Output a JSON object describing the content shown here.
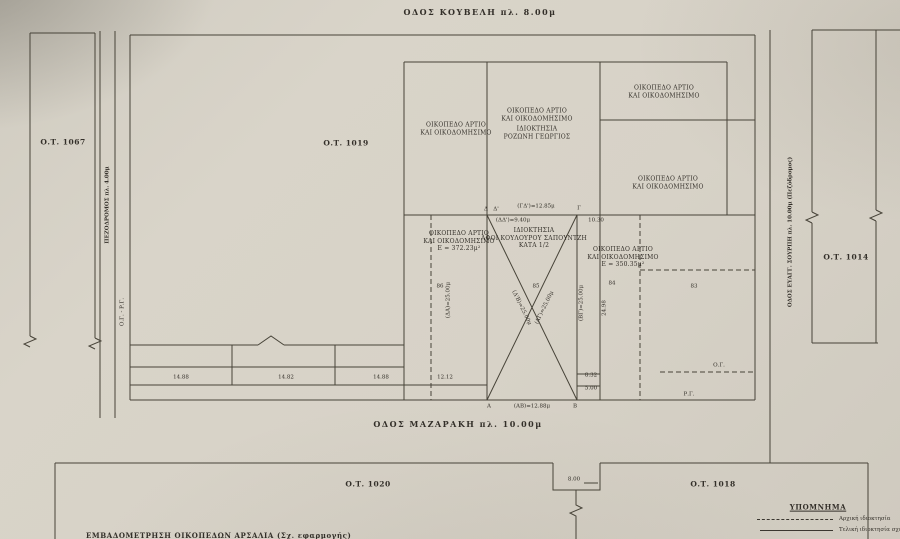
{
  "streets": {
    "koubeli": "ΟΔΟΣ ΚΟΥΒΕΛΗ   πλ. 8.00μ",
    "mazaraki": "ΟΔΟΣ  ΜΑΖΑΡΑΚΗ   πλ. 10.00μ",
    "pezodromos": "ΠΕΖΟΔΡΟΜΟΣ   πλ. 4.00μ",
    "og_rg": "Ο.Γ. - Ρ.Γ.",
    "sourpi": "ΟΔΟΣ ΕΥΑΓΓ. ΣΟΥΡΠΗ   πλ. 10.00μ  (Πεζόδρομος)"
  },
  "blocks": {
    "ot1067": "Ο.Τ. 1067",
    "ot1019": "Ο.Τ. 1019",
    "ot1014": "Ο.Τ. 1014",
    "ot1020": "Ο.Τ. 1020",
    "ot1018": "Ο.Τ. 1018"
  },
  "parcels": {
    "upper_left": {
      "l1": "ΟΙΚΟΠΕΔΟ ΑΡΤΙΟ",
      "l2": "ΚΑΙ ΟΙΚΟΔΟΜΗΣΙΜΟ"
    },
    "upper_mid": {
      "l1": "ΟΙΚΟΠΕΔΟ ΑΡΤΙΟ",
      "l2": "ΚΑΙ ΟΙΚΟΔΟΜΗΣΙΜΟ",
      "l3": "ΙΔΙΟΚΤΗΣΙΑ",
      "l4": "ΡΟΖΩΝΗ ΓΕΩΡΓΙΟΣ"
    },
    "upper_right": {
      "l1": "ΟΙΚΟΠΕΔΟ ΑΡΤΙΟ",
      "l2": "ΚΑΙ ΟΙΚΟΔΟΜΗΣΙΜΟ"
    },
    "mid_right": {
      "l1": "ΟΙΚΟΠΕΔΟ ΑΡΤΙΟ",
      "l2": "ΚΑΙ ΟΙΚΟΔΟΜΗΣΙΜΟ"
    },
    "lower_left": {
      "l1": "ΟΙΚΟΠΕΔΟ ΑΡΤΙΟ",
      "l2": "ΚΑΙ ΟΙΚΟΔΟΜΗΣΙΜΟ",
      "l3": "Ε = 372.23μ²"
    },
    "lower_mid": {
      "l1": "ΙΔΙΟΚΤΗΣΙΑ",
      "l2": "ΑΦΟΙ ΚΟΥΛΟΥΡΟΥ ΣΑΠΟΥΝΤΖΗ",
      "l3": "ΚΑΤΑ 1/2"
    },
    "lower_right": {
      "l1": "ΟΙΚΟΠΕΔΟ ΑΡΤΙΟ",
      "l2": "ΚΑΙ ΟΙΚΟΔΟΜΗΣΙΜΟ",
      "l3": "Ε = 350.35μ²"
    }
  },
  "points": {
    "delta": "Δ",
    "delta_p": "Δ'",
    "gamma": "Γ",
    "alpha": "Α",
    "beta": "Β"
  },
  "dims": {
    "gd": "(ΓΔ')=12.85μ",
    "dd": "(ΔΔ')=9.40μ",
    "w1030": "10.30",
    "ab": "(ΑΒ)=12.88μ",
    "r1": "14.88",
    "r2": "14.82",
    "r3": "14.88",
    "r4": "12.12",
    "v832": "8.32",
    "v500": "5.00",
    "notch800": "8.00",
    "da25": "(ΔΑ)=25.00μ",
    "diag1": "(Δ'Β)=25.00μ",
    "diag2": "(ΑΓ)=25.00μ",
    "bg25": "(ΒΓ)=25.00μ",
    "v2498": "24.98"
  },
  "parcel_numbers": {
    "p86": "86",
    "p85": "85",
    "p84": "84",
    "p83": "83"
  },
  "marks": {
    "og": "Ο.Γ.",
    "rg": "Ρ.Γ."
  },
  "legend": {
    "title": "ΥΠΟΜΝΗΜΑ",
    "items": [
      {
        "style": "dashed",
        "label": "Αρχική ιδιοκτησία"
      },
      {
        "style": "solid",
        "label": "Τελική ιδιοκτησία σχεδίου πόλεως"
      }
    ]
  },
  "footer": "ΕΜΒΑΔΟΜΕΤΡΗΣΗ ΟΙΚΟΠΕΔΩΝ ΑΡΣΑΛΙΑ (Σχ. εφαρμογής)",
  "colors": {
    "paper": "#d6d1c6",
    "ink": "#45413a"
  }
}
